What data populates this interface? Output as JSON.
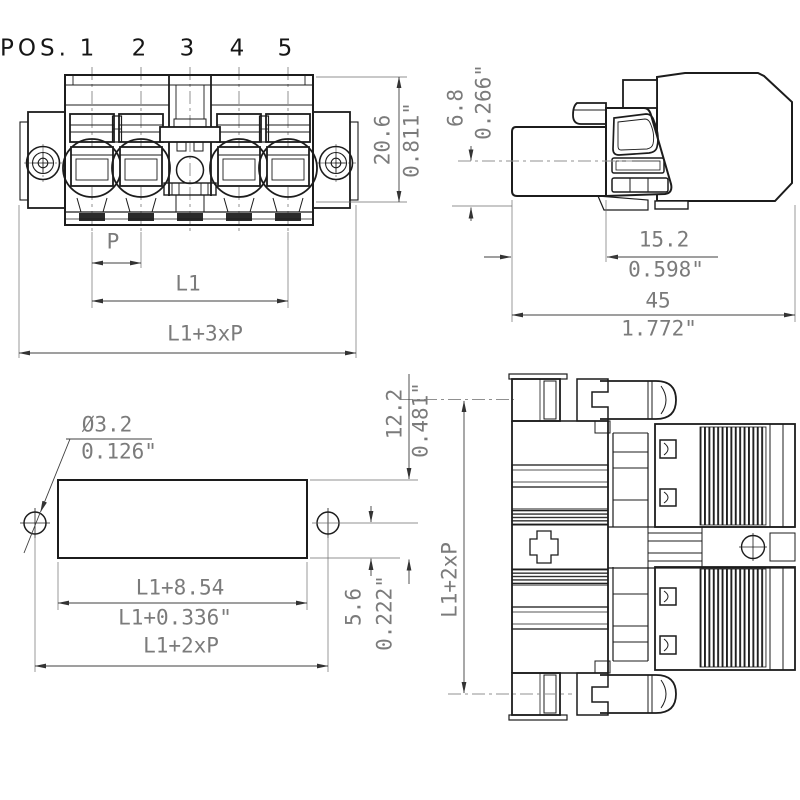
{
  "drawing": {
    "type": "connector-dimensional-drawing",
    "colors": {
      "background": "#ffffff",
      "outline": "#1c1c1c",
      "dimension_line": "#3f3f3f",
      "dimension_text": "#7b7b7b",
      "centerline": "#909090"
    }
  },
  "pos": {
    "label": "POS.",
    "items": [
      "1",
      "2",
      "3",
      "4",
      "5"
    ]
  },
  "dims": {
    "front": {
      "pitch": "P",
      "l1": "L1",
      "total": "L1+3xP",
      "height_mm": "20.6",
      "height_in": "0.811\""
    },
    "side": {
      "offset_mm": "6.8",
      "offset_in": "0.266\"",
      "depth_mm": "15.2",
      "depth_in": "0.598\"",
      "length_mm": "45",
      "length_in": "1.772\""
    },
    "cutout": {
      "hole_mm": "Ø3.2",
      "hole_in": "0.126\"",
      "length_mm": "L1+8.54",
      "length_in": "L1+0.336\"",
      "spacing": "L1+2xP",
      "height_mm": "12.2",
      "height_in": "0.481\"",
      "edge_mm": "5.6",
      "edge_in": "0.222\""
    },
    "top": {
      "height": "L1+2xP"
    }
  }
}
